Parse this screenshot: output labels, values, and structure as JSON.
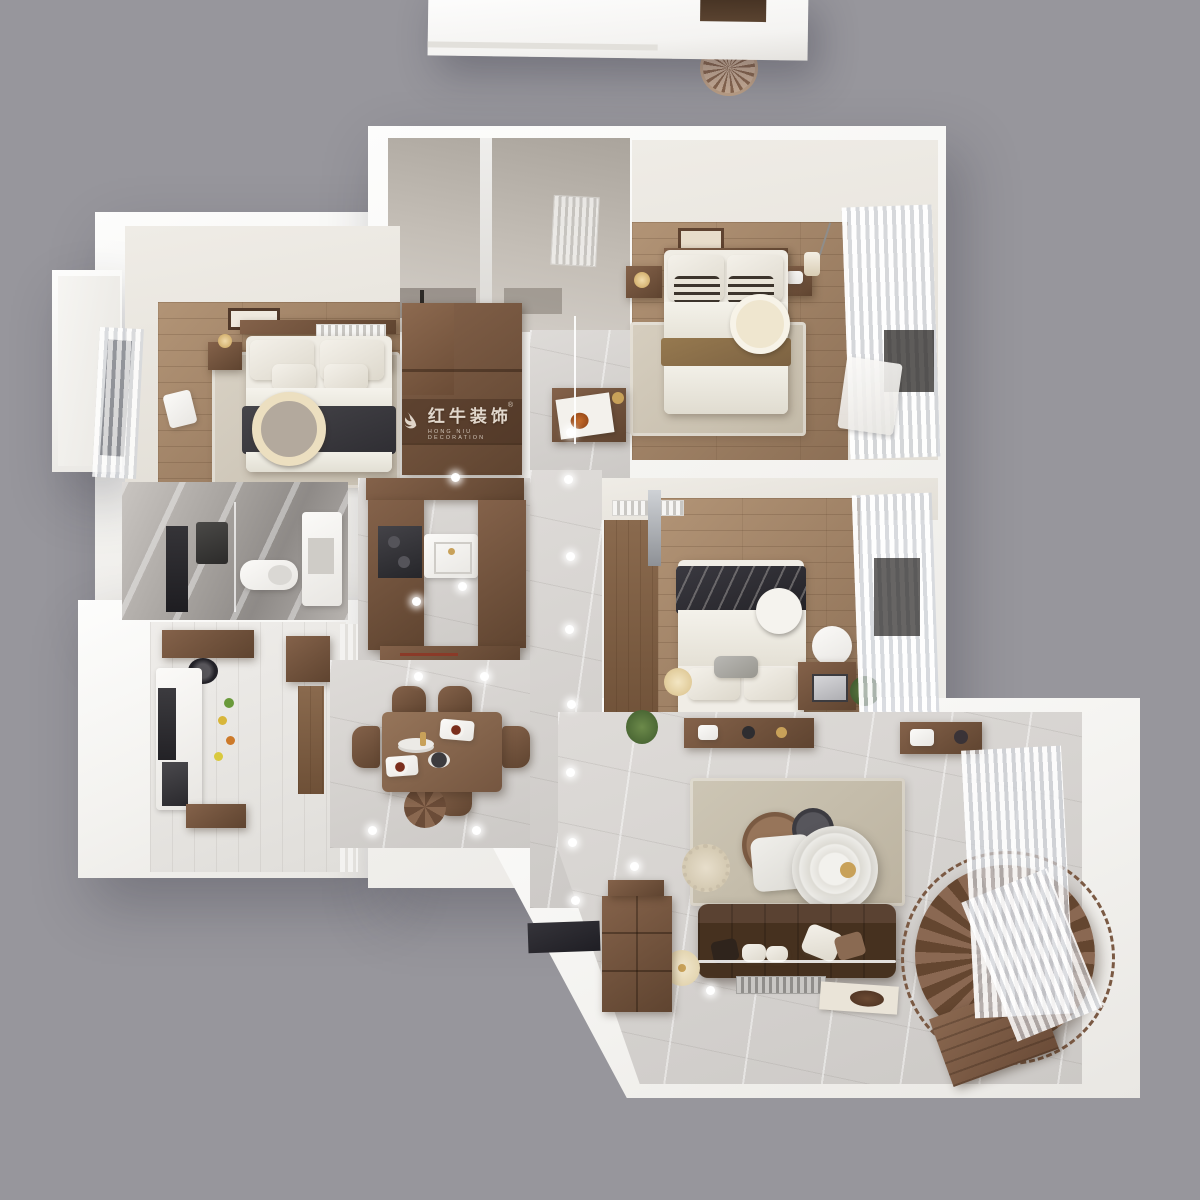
{
  "watermark": {
    "logo_icon": "hongniu-bull-logo",
    "registered_mark": "®",
    "brand_cn": "红牛装饰",
    "brand_en": "HONG NIU DECORATION"
  },
  "palette": {
    "background": "#97969C",
    "wall_white": "#F7F6F3",
    "wood_floor": "#A3856A",
    "dark_wood": "#6E4F3A",
    "cabinet_wood": "#7B5A41",
    "tile_floor": "#D8D5D1",
    "rug_beige": "#D2CABB",
    "sofa_brown": "#4A3429",
    "blanket_dark": "#3A393D",
    "blanket_khaki": "#8A6E4B",
    "stair_wood": "#82614A",
    "accent_gold": "#C8A159"
  }
}
